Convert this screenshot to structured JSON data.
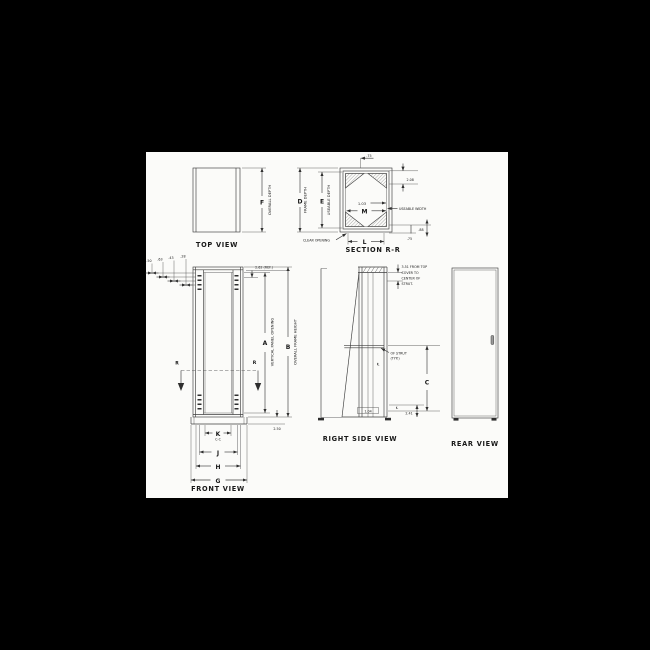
{
  "drawing": {
    "top_view": {
      "title": "TOP VIEW",
      "dim_f": "F",
      "overall_depth": "OVERALL DEPTH"
    },
    "section_rr": {
      "title": "SECTION R-R",
      "dim_d": "D",
      "frame_depth": "FRAME DEPTH",
      "dim_e": "E",
      "useable_depth": "USEABLE DEPTH",
      "dim_m": "M",
      "dim_l": "L",
      "m_offset": "1.03",
      "top_flange": ".75",
      "corner_depth": "2.08",
      "useable_width": "USEABLE WIDTH",
      "clear_opening": "CLEAR OPENING",
      "flange_bottom": ".75",
      "offset_bottom": ".88"
    },
    "front_view": {
      "title": "FRONT VIEW",
      "offsets": [
        ".50",
        ".63",
        ".43",
        ".28"
      ],
      "top_ref": "2.62 (REF.)",
      "dim_a": "A",
      "vertical_panel_opening": "VERTICAL PANEL OPENING",
      "dim_b": "B",
      "overall_frame_height": "OVERALL FRAME HEIGHT",
      "section_marker": "R",
      "dim_k": "K",
      "k_note": "C-C",
      "dim_j": "J",
      "dim_h": "H",
      "dim_g": "G",
      "base_height": "2.50"
    },
    "right_view": {
      "title": "RIGHT SIDE VIEW",
      "top_note_line1": "3.51 FROM TOP",
      "top_note_line2": "COVER TO",
      "top_note_line3": "CENTER OF",
      "top_note_line4": "STRUT.",
      "strut_note_line1": "OF STRUT",
      "strut_note_line2": "(TYP.)",
      "centerline_symbol": "℄",
      "dim_c": "C",
      "bottom_dim": "2.41",
      "foot_dim": "1.04"
    },
    "rear_view": {
      "title": "REAR VIEW"
    }
  }
}
